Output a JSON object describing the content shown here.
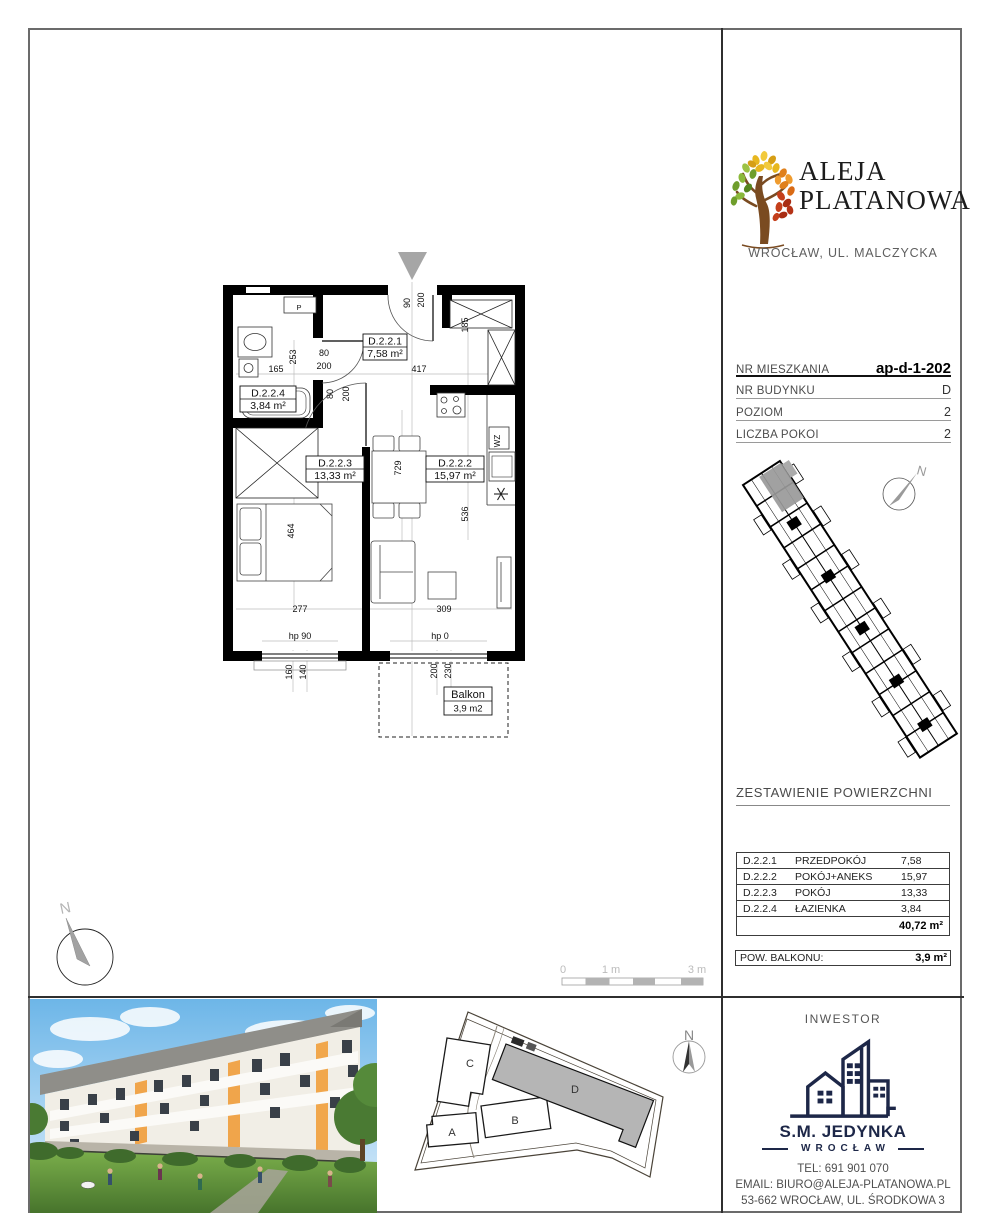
{
  "colors": {
    "logo_navy": "#1d2748",
    "tree_trunk": "#7a4b21",
    "tree_green": "#7fae35",
    "tree_yellow": "#e7b71f",
    "tree_red": "#c43f1b",
    "accent_orange": "#f0a243",
    "unit_highlight_gray": "#9b9b9b"
  },
  "project": {
    "name_line1": "ALEJA",
    "name_line2": "PLATANOWA",
    "location": "WROCŁAW, UL. MALCZYCKA"
  },
  "unit_info": {
    "rows": [
      {
        "label": "NR MIESZKANIA",
        "value": "ap-d-1-202"
      },
      {
        "label": "NR BUDYNKU",
        "value": "D"
      },
      {
        "label": "POZIOM",
        "value": "2"
      },
      {
        "label": "LICZBA POKOI",
        "value": "2"
      }
    ]
  },
  "floor_plan": {
    "rooms": {
      "hall": {
        "code": "D.2.2.1",
        "area": "7,58 m²"
      },
      "living": {
        "code": "D.2.2.2",
        "area": "15,97 m²"
      },
      "bedroom": {
        "code": "D.2.2.3",
        "area": "13,33 m²"
      },
      "bath": {
        "code": "D.2.2.4",
        "area": "3,84 m²"
      }
    },
    "balcony": {
      "name": "Balkon",
      "area": "3,9 m2"
    },
    "dims": {
      "bath_w": "165",
      "bath_h": "253",
      "bath_door_w": "80",
      "bath_door_off": "200",
      "hall_w": "417",
      "entry_w": "90",
      "entry_off": "200",
      "closet_h": "185",
      "bed_door_w": "80",
      "bed_door_off": "200",
      "dining_h": "729",
      "kitchen_h": "536",
      "bed_len": "464",
      "bedroom_w": "277",
      "living_w": "309",
      "win1_hp": "hp 90",
      "win2_hp": "hp 0",
      "win1_h1": "160",
      "win1_h2": "140",
      "win2_h1": "200",
      "win2_h2": "230"
    },
    "labels": {
      "washer": "P",
      "wz": "WZ"
    },
    "north": "N",
    "scale": {
      "t0": "0",
      "t1": "1 m",
      "t3": "3 m"
    }
  },
  "overview": {
    "north": "N"
  },
  "areas_table": {
    "title": "ZESTAWIENIE POWIERZCHNI",
    "rows": [
      {
        "code": "D.2.2.1",
        "name": "PRZEDPOKÓJ",
        "area": "7,58"
      },
      {
        "code": "D.2.2.2",
        "name": "POKÓJ+ANEKS",
        "area": "15,97"
      },
      {
        "code": "D.2.2.3",
        "name": "POKÓJ",
        "area": "13,33"
      },
      {
        "code": "D.2.2.4",
        "name": "ŁAZIENKA",
        "area": "3,84"
      }
    ],
    "total": "40,72 m²",
    "balcony_label": "POW. BALKONU:",
    "balcony_value": "3,9 m²"
  },
  "site_plan": {
    "buildings": {
      "a": "A",
      "b": "B",
      "c": "C",
      "d": "D"
    },
    "north": "N"
  },
  "investor": {
    "title": "INWESTOR",
    "name": "S.M. JEDYNKA",
    "city": "WROCŁAW",
    "tel": "TEL: 691 901 070",
    "email": "EMAIL: BIURO@ALEJA-PLATANOWA.PL",
    "address": "53-662 WROCŁAW, UL. ŚRODKOWA 3"
  }
}
